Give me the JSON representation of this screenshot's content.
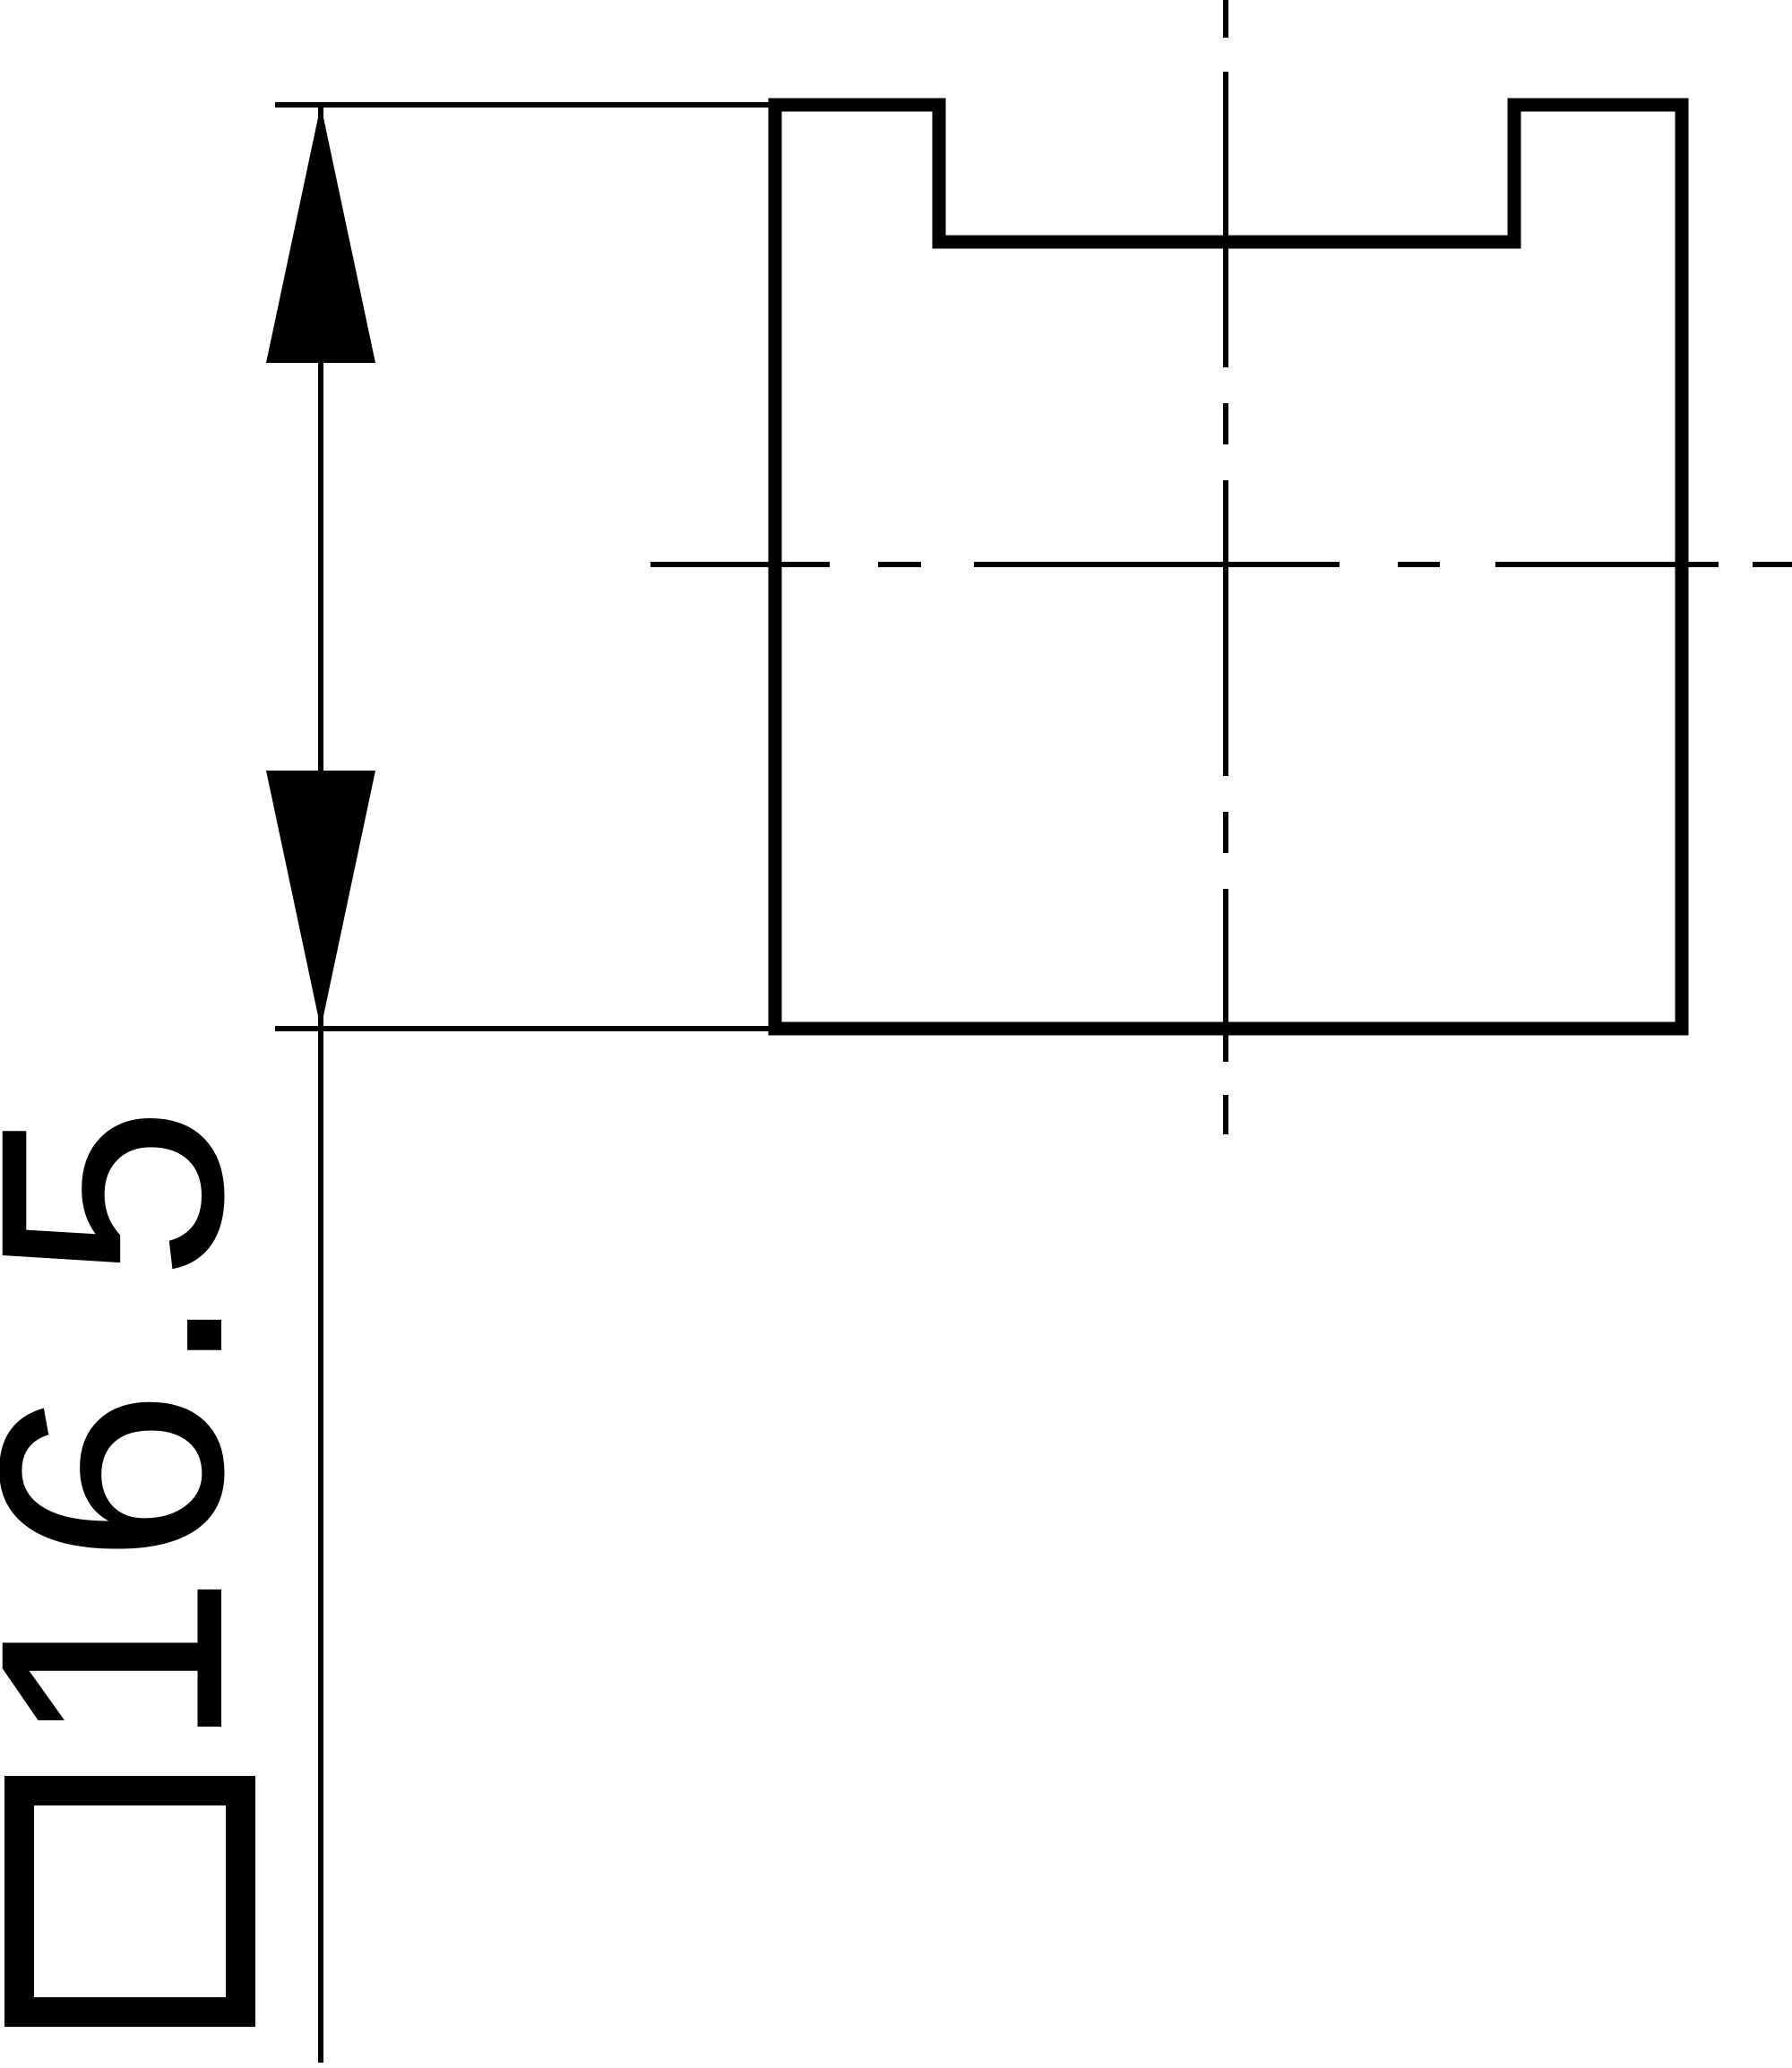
{
  "drawing": {
    "kind": "technical-drawing-orthographic-view",
    "description": "Square bar profile with top slot, vertical size dimension",
    "dimension_label": {
      "symbol": "square",
      "value": "16.5",
      "full_text": "□16.5"
    },
    "colors": {
      "ink": "#000000",
      "background": "#ffffff"
    }
  }
}
